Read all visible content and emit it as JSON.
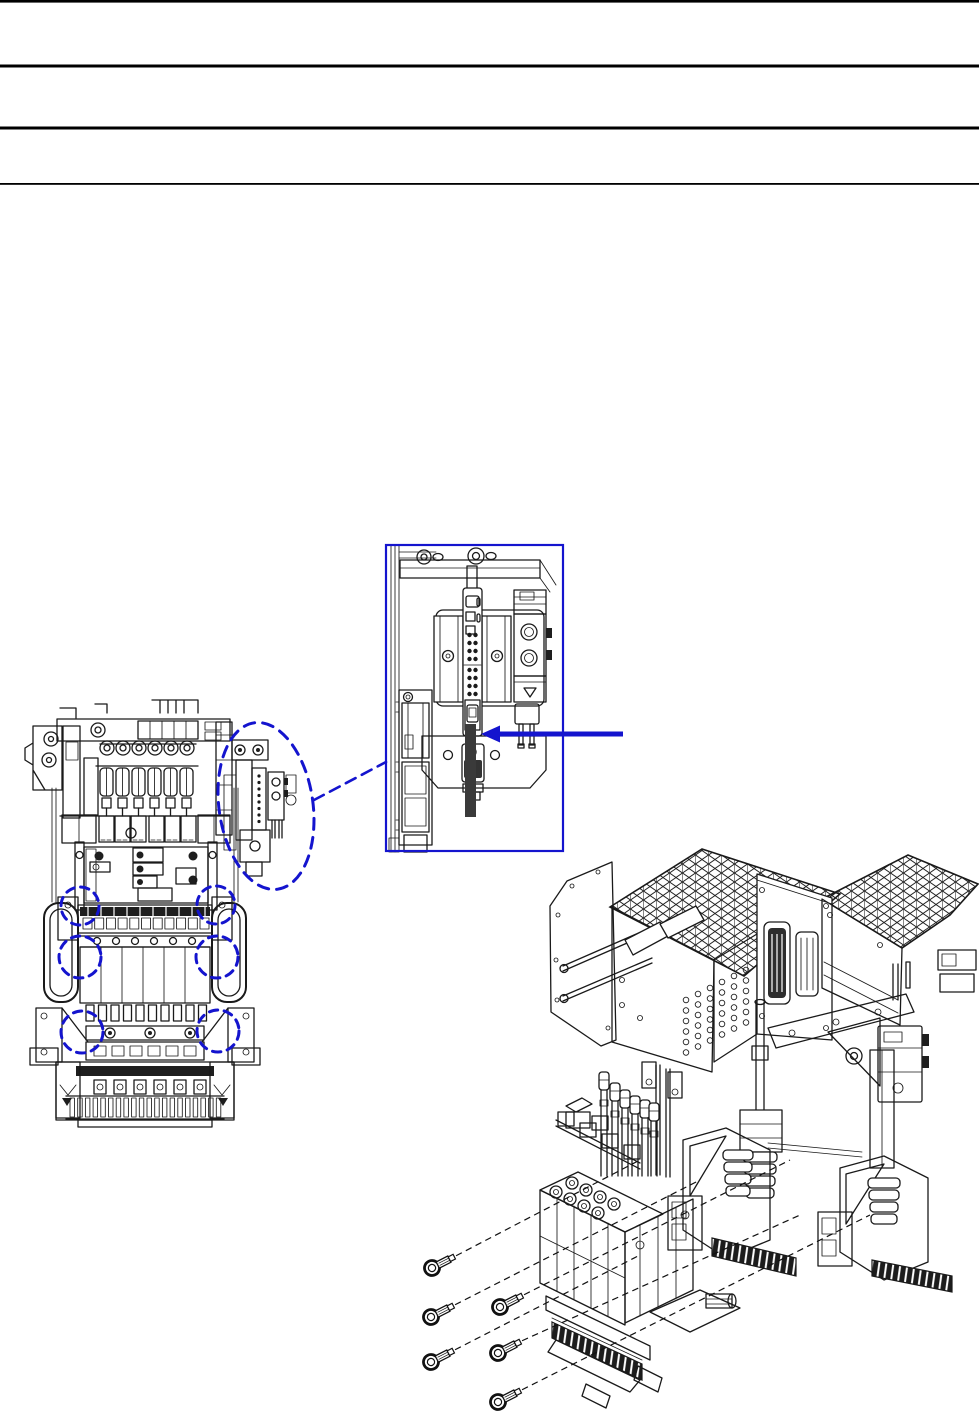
{
  "page": {
    "width": 979,
    "height": 1411,
    "background": "#ffffff",
    "description": "Technical manual page: machine front view with blue dashed highlights, blue detail callout box with arrow pointing at cable, and exploded isometric assembly view with six mounting screws"
  },
  "colors": {
    "line": "#1a1a1a",
    "annotation_blue": "#1414CE",
    "cable_dark": "#3a3a3a",
    "rule_black": "#000000"
  },
  "header": {
    "rules": [
      {
        "y": 0,
        "thickness": 2.6
      },
      {
        "y": 64.5,
        "thickness": 3.0
      },
      {
        "y": 126.5,
        "thickness": 3.0
      },
      {
        "y": 183,
        "thickness": 1.8
      }
    ]
  },
  "figures": {
    "front_view": {
      "label": "machine-front-view",
      "x": 25,
      "y": 698,
      "width": 300,
      "height": 432
    },
    "detail_callout": {
      "box": {
        "x": 386,
        "y": 545,
        "width": 177,
        "height": 306
      },
      "arrow": {
        "tip_x": 481,
        "tip_y": 734,
        "tail_x": 623,
        "tail_y": 734,
        "head_len": 19,
        "head_half": 8.5,
        "shaft": 5
      },
      "cable": {
        "x": 465,
        "y": 724,
        "width": 11,
        "height": 93
      }
    },
    "exploded_view": {
      "label": "exploded-isometric-view",
      "x": 420,
      "y": 845,
      "width": 559,
      "height": 566,
      "screw_count": 6
    }
  },
  "annotations": {
    "ellipse": {
      "cx": 266,
      "cy": 806,
      "rx": 47,
      "ry": 84,
      "rotate": -8,
      "dash": "11 8",
      "stroke_width": 3
    },
    "leader_line": {
      "x1": 314,
      "y1": 800,
      "x2": 386,
      "y2": 762,
      "dash": "11 7",
      "stroke_width": 2.6
    },
    "circles": [
      {
        "cx": 80,
        "cy": 906,
        "r": 19
      },
      {
        "cx": 216,
        "cy": 905,
        "r": 19
      },
      {
        "cx": 80,
        "cy": 957,
        "r": 21
      },
      {
        "cx": 217,
        "cy": 957,
        "r": 21
      },
      {
        "cx": 82,
        "cy": 1032,
        "r": 21
      },
      {
        "cx": 218,
        "cy": 1031,
        "r": 21
      }
    ],
    "circle_dash": "8.5 6.5",
    "circle_stroke_width": 3,
    "screws": [
      {
        "x": 432,
        "y": 1268,
        "to": [
          640,
          1160
        ]
      },
      {
        "x": 431,
        "y": 1317,
        "to": [
          700,
          1180
        ]
      },
      {
        "x": 431,
        "y": 1362,
        "to": [
          640,
          1255
        ]
      },
      {
        "x": 500,
        "y": 1307,
        "to": [
          790,
          1160
        ]
      },
      {
        "x": 498,
        "y": 1353,
        "to": [
          800,
          1215
        ]
      },
      {
        "x": 498,
        "y": 1402,
        "to": [
          870,
          1215
        ]
      }
    ],
    "screw_angle": -27,
    "traj_dash": "6.5 4.5"
  },
  "front_view_parts": {
    "washers": {
      "count": 6,
      "start_x": 107,
      "step": 16,
      "y": 748,
      "r": 7,
      "r2": 3
    },
    "tension_units": {
      "count": 6,
      "start_x": 100,
      "step": 16,
      "y": 768,
      "w": 13,
      "h": 28
    },
    "needle_circles": {
      "count": 6,
      "start_x": 97,
      "step": 19,
      "y": 941,
      "r": 3.5
    },
    "panel_columns": {
      "count": 5,
      "start_x": 101,
      "step": 21,
      "y1": 947,
      "y2": 1003
    },
    "square_row": {
      "count": 11,
      "start_x": 83,
      "step": 11.7,
      "y": 918,
      "w": 9,
      "h": 11
    },
    "dark_band_ticks": {
      "count": 10,
      "start_x": 88,
      "step": 13,
      "y": 907,
      "h": 9
    },
    "comb_slats": {
      "count": 10,
      "start_x": 86,
      "step": 12.5,
      "y": 1005,
      "w": 8,
      "h": 16
    },
    "base_squares": {
      "count": 6,
      "start_x": 94,
      "step": 20,
      "y": 1080,
      "w": 12,
      "h": 14
    },
    "base_comb": {
      "count": 20,
      "start_x": 70,
      "step": 7.7,
      "y": 1098,
      "w": 4.5,
      "h": 19
    },
    "attachment_dots": {
      "x": 259,
      "y0": 776,
      "step": 6.5,
      "count": 8,
      "r": 1.6
    }
  },
  "detail_parts": {
    "dot_cols": [
      469.5,
      475.5
    ],
    "dot_blocks": [
      {
        "y0": 635,
        "rows": 4,
        "step": 8
      },
      {
        "y0": 670,
        "rows": 4,
        "step": 8
      }
    ],
    "dot_r": 2.2
  },
  "iso_parts": {
    "hole_grid": {
      "cols": 6,
      "rows": 6,
      "x0": 686,
      "col_dx": 12,
      "y0": 1000,
      "col_dy": -6,
      "row_dy": 10.5,
      "r": 2.8
    },
    "plungers": {
      "xs": [
        604,
        615,
        625,
        635,
        645,
        654
      ],
      "ys": [
        1072,
        1083,
        1090,
        1096,
        1100,
        1103
      ],
      "bottom": 1176
    },
    "bellows_left": {
      "cx": 760,
      "y0": 1152,
      "count": 4,
      "step": 12,
      "w": 34
    },
    "bellows_mid": {
      "cx": 738,
      "y0": 1150,
      "count": 4,
      "step": 12,
      "w": 30
    },
    "bellows_right": {
      "cx": 884,
      "y0": 1178,
      "count": 4,
      "step": 12,
      "w": 32
    }
  }
}
